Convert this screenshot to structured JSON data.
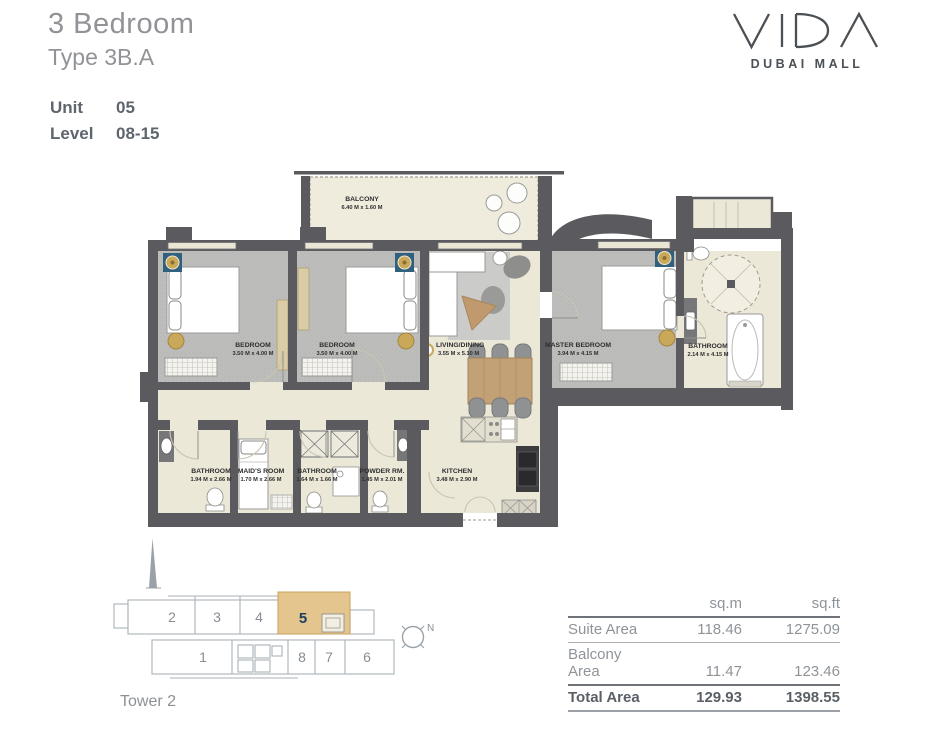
{
  "header": {
    "title": "3 Bedroom",
    "subtitle": "Type 3B.A",
    "unit_label": "Unit",
    "unit_value": "05",
    "level_label": "Level",
    "level_value": "08-15"
  },
  "brand": {
    "name": "VIDA",
    "location": "DUBAI MALL"
  },
  "floorplan": {
    "balcony": {
      "name": "BALCONY",
      "dims": "6.40 M x 1.60 M"
    },
    "bedroom1": {
      "name": "BEDROOM",
      "dims": "3.50 M x 4.00 M"
    },
    "bedroom2": {
      "name": "BEDROOM",
      "dims": "3.50 M x 4.00 M"
    },
    "living": {
      "name": "LIVING/DINING",
      "dims": "3.55 M x 5.10 M"
    },
    "master": {
      "name": "MASTER BEDROOM",
      "dims": "3.94 M x 4.15 M"
    },
    "master_bath": {
      "name": "BATHROOM",
      "dims": "2.14 M x 4.15 M"
    },
    "bath1": {
      "name": "BATHROOM",
      "dims": "1.94 M x 2.66 M"
    },
    "maids": {
      "name": "MAID'S ROOM",
      "dims": "1.70 M x 2.66 M"
    },
    "bath2": {
      "name": "BATHROOM",
      "dims": "1.64 M x 1.66 M"
    },
    "powder": {
      "name": "POWDER RM.",
      "dims": "1.45 M x 2.01 M"
    },
    "kitchen": {
      "name": "KITCHEN",
      "dims": "3.48 M x 2.90 M"
    }
  },
  "keyplan": {
    "tower_label": "Tower 2",
    "compass": "N",
    "units": {
      "u1": "1",
      "u2": "2",
      "u3": "3",
      "u4": "4",
      "u5": "5",
      "u6": "6",
      "u7": "7",
      "u8": "8"
    }
  },
  "area_table": {
    "col_sqm": "sq.m",
    "col_sqft": "sq.ft",
    "rows": [
      {
        "label": "Suite Area",
        "sqm": "118.46",
        "sqft": "1275.09"
      },
      {
        "label": "Balcony Area",
        "sqm": "11.47",
        "sqft": "123.46"
      },
      {
        "label": "Total Area",
        "sqm": "129.93",
        "sqft": "1398.55"
      }
    ]
  },
  "colors": {
    "wall": "#5b5b5f",
    "floor": "#ece8d8",
    "carpet": "#bcbcba",
    "keyplan_highlight": "#e4c58d",
    "gold": "#c9a85a",
    "medallion_blue": "#31607e",
    "unit_navy": "#1c3f5e",
    "text_grey": "#8f9499",
    "brand_grey": "#4b5055"
  }
}
